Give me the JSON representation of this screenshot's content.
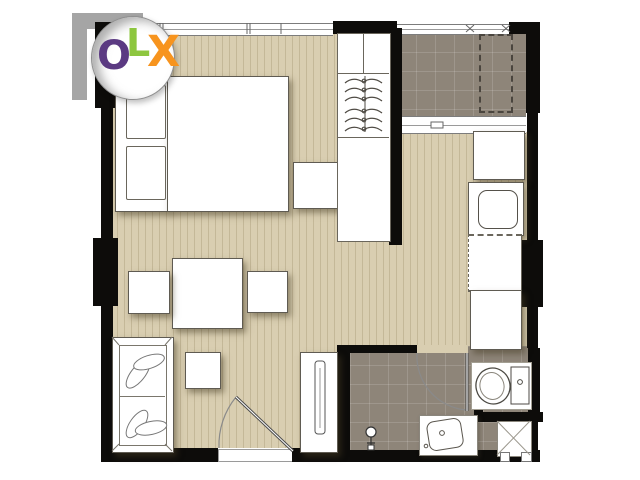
{
  "watermark": {
    "text": "OLX",
    "letters": [
      {
        "char": "O",
        "color": "#5b3a82"
      },
      {
        "char": "L",
        "color": "#8dc63f"
      },
      {
        "char": "X",
        "color": "#f7941e"
      }
    ]
  },
  "palette": {
    "background": "#ffffff",
    "wall": "#0d0c0a",
    "wood_floor": "#d9ceb1",
    "wood_plank_line": "#c3b692",
    "tile_floor": "#8e8579",
    "furniture_fill": "#ffffff",
    "furniture_outline": "#5f5b52"
  },
  "areas": [
    {
      "name": "sleeping-living-area",
      "floor": "wood"
    },
    {
      "name": "balcony",
      "floor": "tile"
    },
    {
      "name": "kitchen",
      "floor": "wood"
    },
    {
      "name": "bathroom",
      "floor": "tile"
    },
    {
      "name": "service-shaft",
      "floor": "hatched"
    }
  ],
  "fixtures": [
    "double-bed",
    "pillows",
    "nightstand",
    "wardrobe-with-hangers",
    "dining-table",
    "stools",
    "sofa",
    "tv-console",
    "entrance-door",
    "refrigerator",
    "kitchen-sink",
    "kitchen-counters",
    "sliding-window",
    "toilet",
    "washbasin",
    "shower-fixture",
    "ac-unit",
    "windows"
  ]
}
